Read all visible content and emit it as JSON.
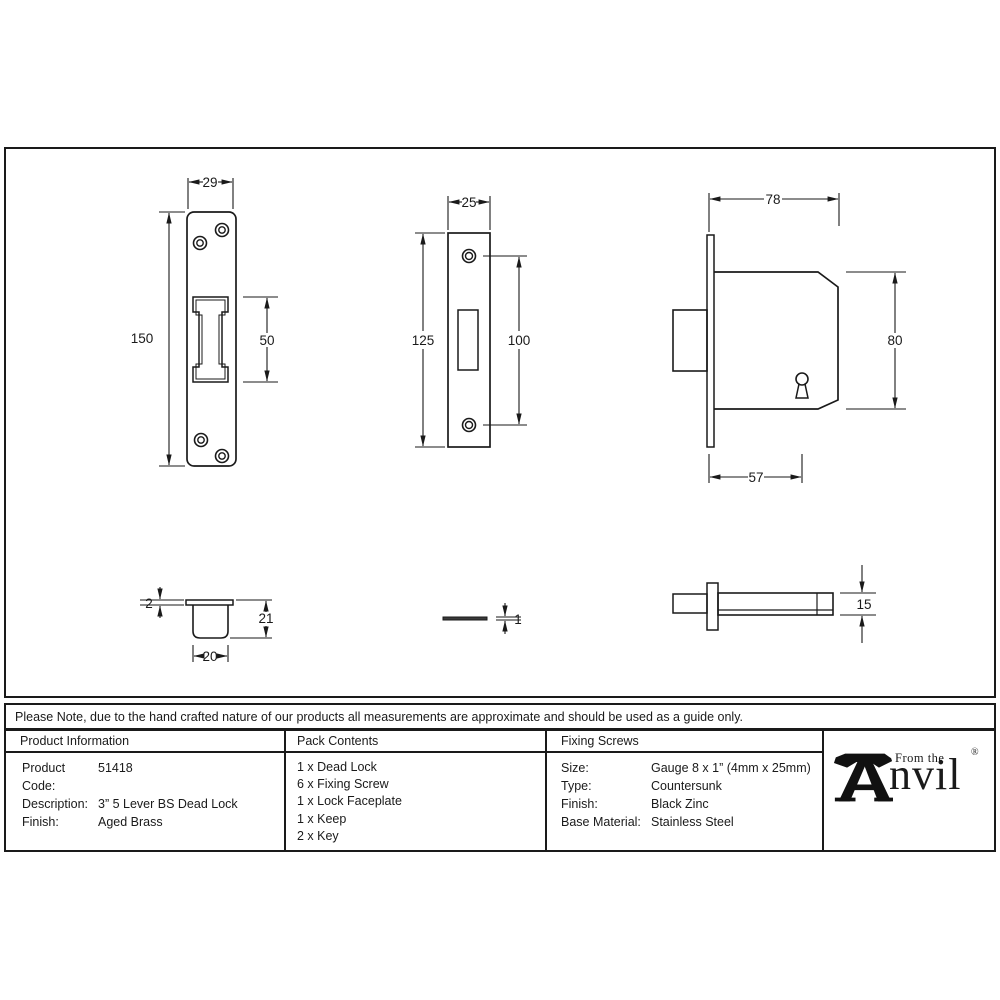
{
  "note": "Please Note, due to the hand crafted nature of our products all measurements are approximate and should be used as a guide only.",
  "drawing_labels": {
    "faceplate_front": {
      "width": "29",
      "height": "150",
      "cutout_height": "50"
    },
    "keep_front": {
      "width": "25",
      "height": "125",
      "hole_spacing": "100"
    },
    "lock_side": {
      "width": "78",
      "height": "80",
      "backset": "57"
    },
    "keep_side": {
      "flange_thickness": "2",
      "depth": "21",
      "width": "20"
    },
    "faceplate_side": {
      "thickness": "1"
    },
    "lock_top": {
      "thickness": "15"
    }
  },
  "table": {
    "product_info": {
      "header": "Product Information",
      "rows": [
        {
          "label": "Product Code:",
          "value": "51418"
        },
        {
          "label": "Description:",
          "value": "3” 5 Lever BS Dead Lock"
        },
        {
          "label": "Finish:",
          "value": "Aged Brass"
        }
      ]
    },
    "pack_contents": {
      "header": "Pack Contents",
      "items": [
        "1 x Dead Lock",
        "6 x Fixing Screw",
        "1 x Lock Faceplate",
        "1 x Keep",
        "2 x Key"
      ]
    },
    "fixing_screws": {
      "header": "Fixing Screws",
      "rows": [
        {
          "label": "Size:",
          "value": "Gauge 8 x 1” (4mm x 25mm)"
        },
        {
          "label": "Type:",
          "value": "Countersunk"
        },
        {
          "label": "Finish:",
          "value": "Black Zinc"
        },
        {
          "label": "Base Material:",
          "value": "Stainless Steel"
        }
      ]
    },
    "logo": {
      "from_the": "From the",
      "name": "nvil",
      "registered": "®"
    }
  },
  "colors": {
    "ink": "#1a1a1a",
    "background": "#ffffff"
  }
}
